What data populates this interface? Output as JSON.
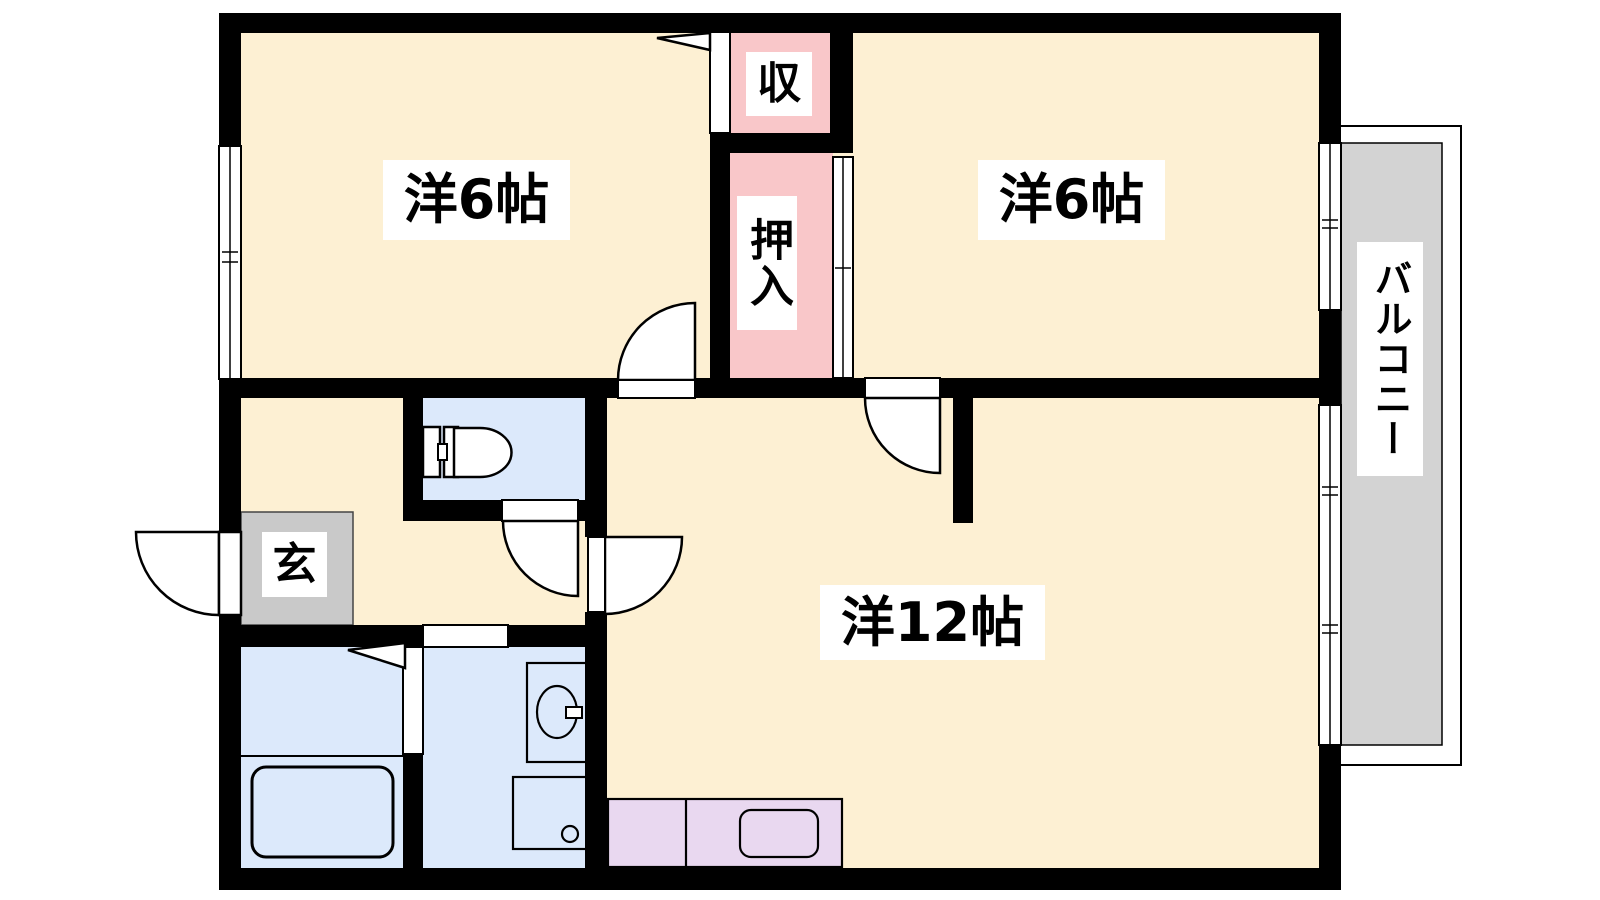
{
  "plan": {
    "title": "2LDK apartment floor plan",
    "rooms": {
      "bedroom_left": {
        "label": "洋6帖"
      },
      "bedroom_right": {
        "label": "洋6帖"
      },
      "living": {
        "label": "洋12帖"
      },
      "storage": {
        "label": "収"
      },
      "closet": {
        "label": "押入"
      },
      "entrance": {
        "label": "玄"
      },
      "balcony": {
        "label": "バルコニー"
      }
    },
    "colors": {
      "room_fill": "#fdf0d3",
      "closet_fill": "#f9c7c9",
      "wet_area_fill": "#dce9fb",
      "entrance_fill": "#c9c9c9",
      "balcony_fill": "#d3d3d3",
      "kitchen_fill": "#e9d8f0",
      "wall": "#000000"
    }
  }
}
